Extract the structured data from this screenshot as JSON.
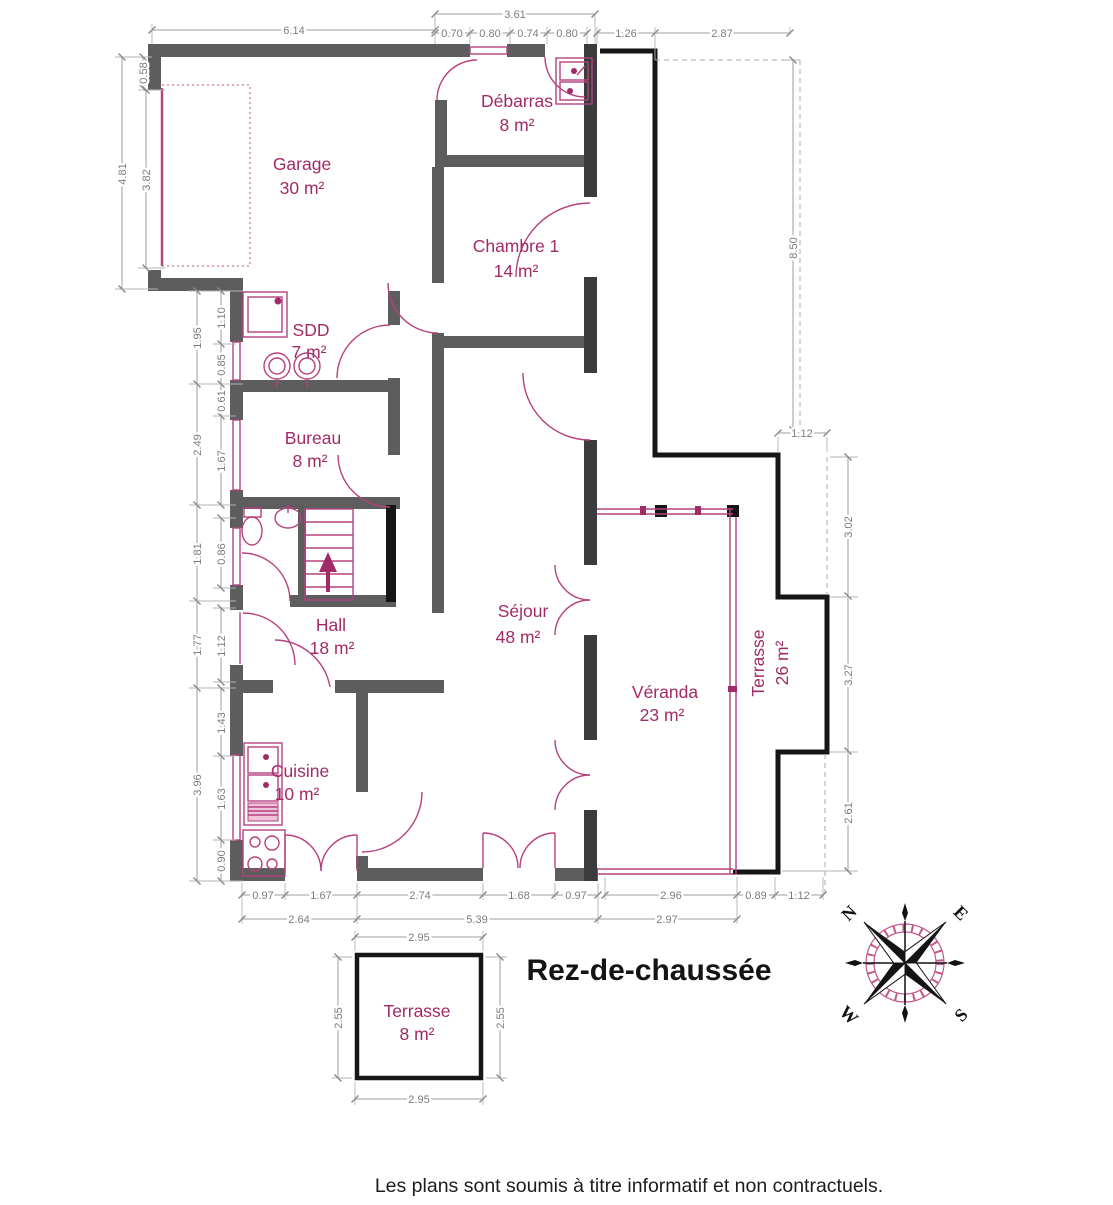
{
  "title": "Rez-de-chaussée",
  "footer": "Les plans sont soumis à titre informatif et non contractuels.",
  "rooms": {
    "garage": {
      "name": "Garage",
      "area": "30 m²"
    },
    "debarras": {
      "name": "Débarras",
      "area": "8 m²"
    },
    "chambre1": {
      "name": "Chambre 1",
      "area": "14 m²"
    },
    "sdd": {
      "name": "SDD",
      "area": "7 m²"
    },
    "bureau": {
      "name": "Bureau",
      "area": "8 m²"
    },
    "hall": {
      "name": "Hall",
      "area": "18 m²"
    },
    "sejour": {
      "name": "Séjour",
      "area": "48 m²"
    },
    "veranda": {
      "name": "Véranda",
      "area": "23 m²"
    },
    "terrasse_est": {
      "name": "Terrasse",
      "area": "26 m²"
    },
    "cuisine": {
      "name": "Cuisine",
      "area": "10 m²"
    },
    "terrasse_sud": {
      "name": "Terrasse",
      "area": "8 m²"
    }
  },
  "dims": {
    "top": [
      "6.14",
      "3.61",
      "0.70",
      "0.80",
      "0.74",
      "0.80",
      "1.26",
      "2.87"
    ],
    "left_garage": [
      "0.58",
      "4.81",
      "3.82"
    ],
    "left": [
      "1.95",
      "1.10",
      "0.85",
      "2.49",
      "0.61",
      "1.67",
      "1.81",
      "0.86",
      "1.77",
      "1.12",
      "3.96",
      "1.43",
      "1.63",
      "0.90"
    ],
    "bottom_inner": [
      "0.97",
      "1.67",
      "2.74",
      "1.68",
      "0.97",
      "2.96",
      "0.89",
      "1.12"
    ],
    "bottom_outer": [
      "2.64",
      "5.39",
      "2.97"
    ],
    "right": [
      "8.50",
      "1.12",
      "3.02",
      "3.27",
      "2.61"
    ],
    "terrasse_sud": [
      "2.95",
      "2.55",
      "2.55",
      "2.95"
    ]
  },
  "compass": {
    "north": "N",
    "east": "E",
    "south": "S",
    "west": "W"
  },
  "colors": {
    "wall_grey": "#5d5d5d",
    "wall_dark": "#3b3b3b",
    "outline_black": "#161616",
    "accent_pink": "#a12b66",
    "fixture_pink": "#b5417f",
    "dim_grey": "#7c7c7c"
  }
}
